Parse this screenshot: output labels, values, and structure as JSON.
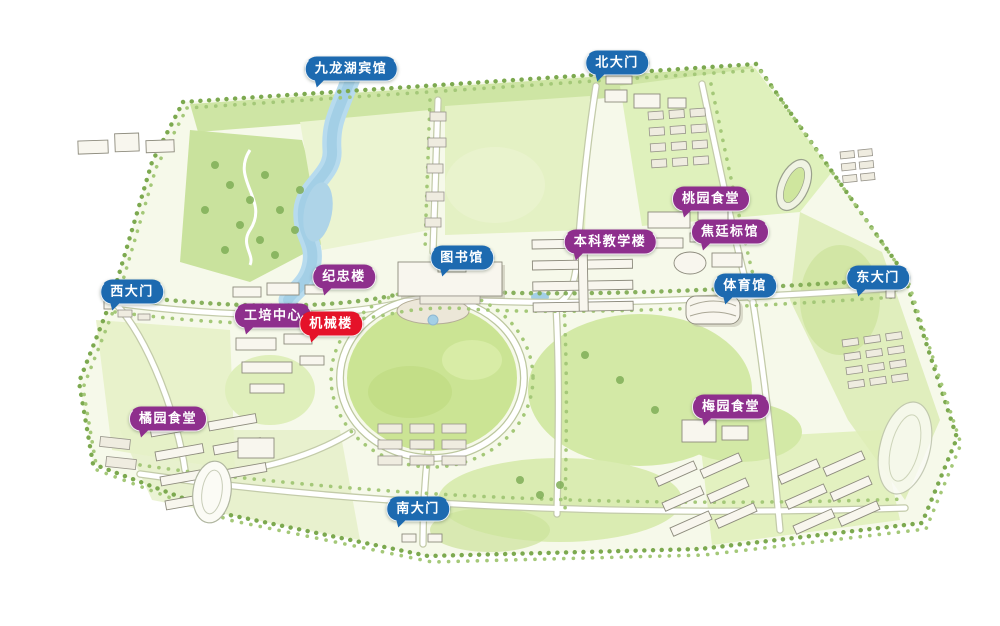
{
  "map": {
    "label_colors": {
      "blue": "#1d6ab0",
      "purple": "#8e2f8d",
      "red": "#e51229"
    },
    "labels": [
      {
        "text": "九龙湖宾馆",
        "type": "blue",
        "x": 351,
        "y": 69
      },
      {
        "text": "北大门",
        "type": "blue",
        "x": 617,
        "y": 63
      },
      {
        "text": "桃园食堂",
        "type": "purple",
        "x": 711,
        "y": 199
      },
      {
        "text": "焦廷标馆",
        "type": "purple",
        "x": 730,
        "y": 232
      },
      {
        "text": "本科教学楼",
        "type": "purple",
        "x": 610,
        "y": 242
      },
      {
        "text": "图书馆",
        "type": "blue",
        "x": 462,
        "y": 258
      },
      {
        "text": "纪忠楼",
        "type": "purple",
        "x": 344,
        "y": 277
      },
      {
        "text": "体育馆",
        "type": "blue",
        "x": 745,
        "y": 286
      },
      {
        "text": "东大门",
        "type": "blue",
        "x": 878,
        "y": 278
      },
      {
        "text": "西大门",
        "type": "blue",
        "x": 132,
        "y": 292
      },
      {
        "text": "工培中心",
        "type": "purple",
        "x": 273,
        "y": 316
      },
      {
        "text": "机械楼",
        "type": "red",
        "x": 331,
        "y": 324
      },
      {
        "text": "橘园食堂",
        "type": "purple",
        "x": 168,
        "y": 419
      },
      {
        "text": "梅园食堂",
        "type": "purple",
        "x": 731,
        "y": 407
      },
      {
        "text": "南大门",
        "type": "blue",
        "x": 418,
        "y": 509
      }
    ]
  }
}
